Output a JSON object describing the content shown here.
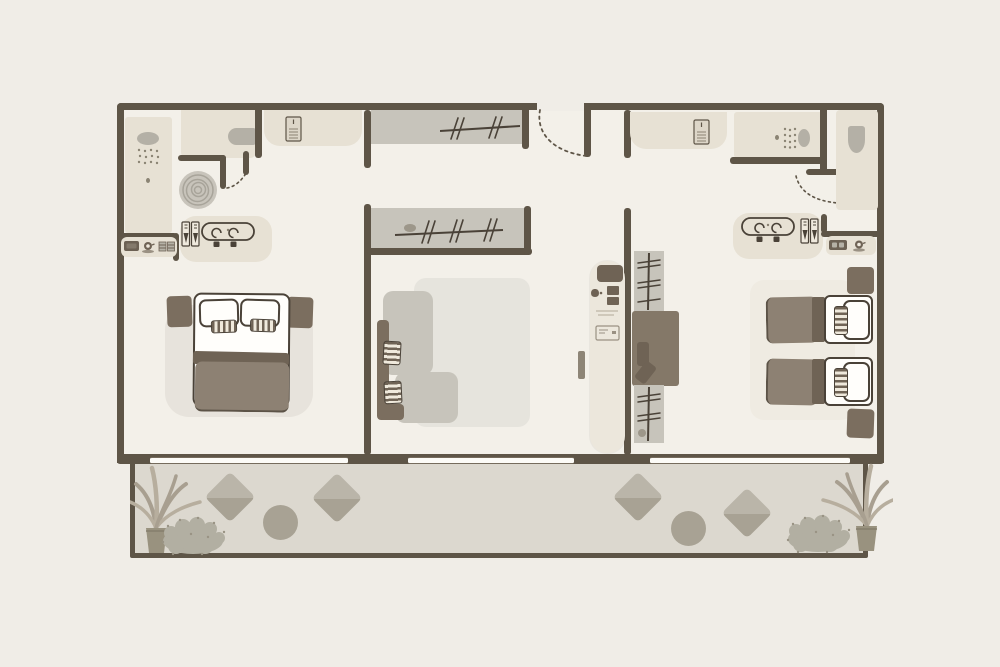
{
  "meta": {
    "description": "Two-bedroom hotel suite floor plan: left bedroom with king bed and bathroom, central living room with wardrobes and L-shaped sofa, right bedroom with twin beds, desk and bathroom, shared furnished terrace along the bottom",
    "visible_text": ""
  },
  "palette": {
    "canvas_bg": "#f0ede7",
    "floor": "#f3f0e9",
    "wall": "#5e5547",
    "outline": "#4a4238",
    "beige": "#e7e1d4",
    "beige_light": "#ece7dc",
    "gray": "#c7c4bb",
    "gray_dark": "#b4b0a6",
    "rug": "#e6e4dd",
    "brown": "#7b6e5f",
    "brown_dark": "#6f6355",
    "duvet": "#8d8173",
    "bed_white": "#fffefb",
    "terrace_floor": "#dcd8cf",
    "terrace_item": "#a8a294",
    "terrace_item_light": "#bab5a9",
    "plant": "#a89f90",
    "plant_light": "#b7ae9e",
    "bush": "#b2afa2",
    "stripe_cream": "#efe9dc",
    "desk": "#847868",
    "window_glass": "#fcfbf7"
  },
  "floor_plan": {
    "rooms": [
      {
        "name": "left-bedroom",
        "features": [
          "walk-in-shower",
          "wc",
          "spiral-rug",
          "double-sink-vanity",
          "coffee-station",
          "king-bed",
          "two-nightstands",
          "sliding-door-to-terrace"
        ]
      },
      {
        "name": "living-room",
        "features": [
          "entry-door",
          "two-wardrobes-with-hangers",
          "l-shaped-sofa",
          "area-rug",
          "minibar-cabinet",
          "sliding-door-to-terrace"
        ]
      },
      {
        "name": "right-bedroom",
        "features": [
          "walk-in-shower",
          "wc",
          "double-sink-vanity",
          "coffee-station",
          "two-twin-beds",
          "two-nightstands",
          "desk-with-chair",
          "closet-with-hangers",
          "sliding-door-to-terrace"
        ]
      },
      {
        "name": "terrace",
        "features": [
          "four-lounge-chairs",
          "two-round-side-tables",
          "two-potted-palms",
          "two-shrubs"
        ]
      }
    ]
  }
}
